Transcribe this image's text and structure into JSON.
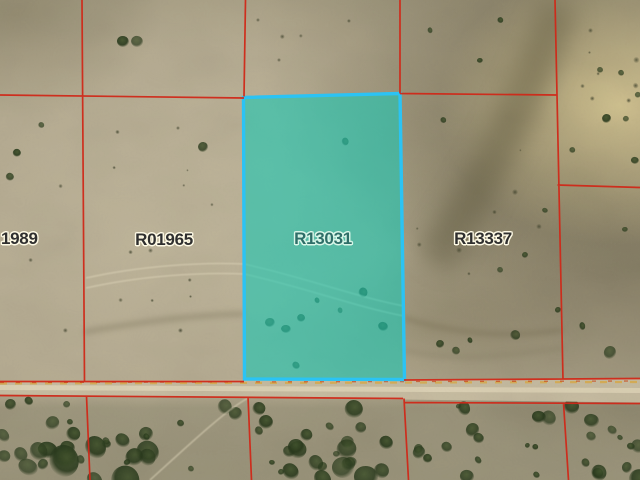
{
  "map": {
    "type": "aerial-parcel-map",
    "selected_parcel_id": "R13031",
    "parcels": [
      {
        "label": "1989",
        "selected": false
      },
      {
        "label": "R01965",
        "selected": false
      },
      {
        "label": "R13031",
        "selected": true
      },
      {
        "label": "R13337",
        "selected": false
      }
    ],
    "colors": {
      "boundary_line": "#d02818",
      "selection_border": "#2bc3f4",
      "selection_fill": "rgba(27,200,180,0.6)",
      "label_text": "#2f2f2f",
      "label_halo": "#fdf9e4",
      "selected_label_text": "#2e6e68",
      "selected_label_halo": "#d8f6e8"
    }
  }
}
